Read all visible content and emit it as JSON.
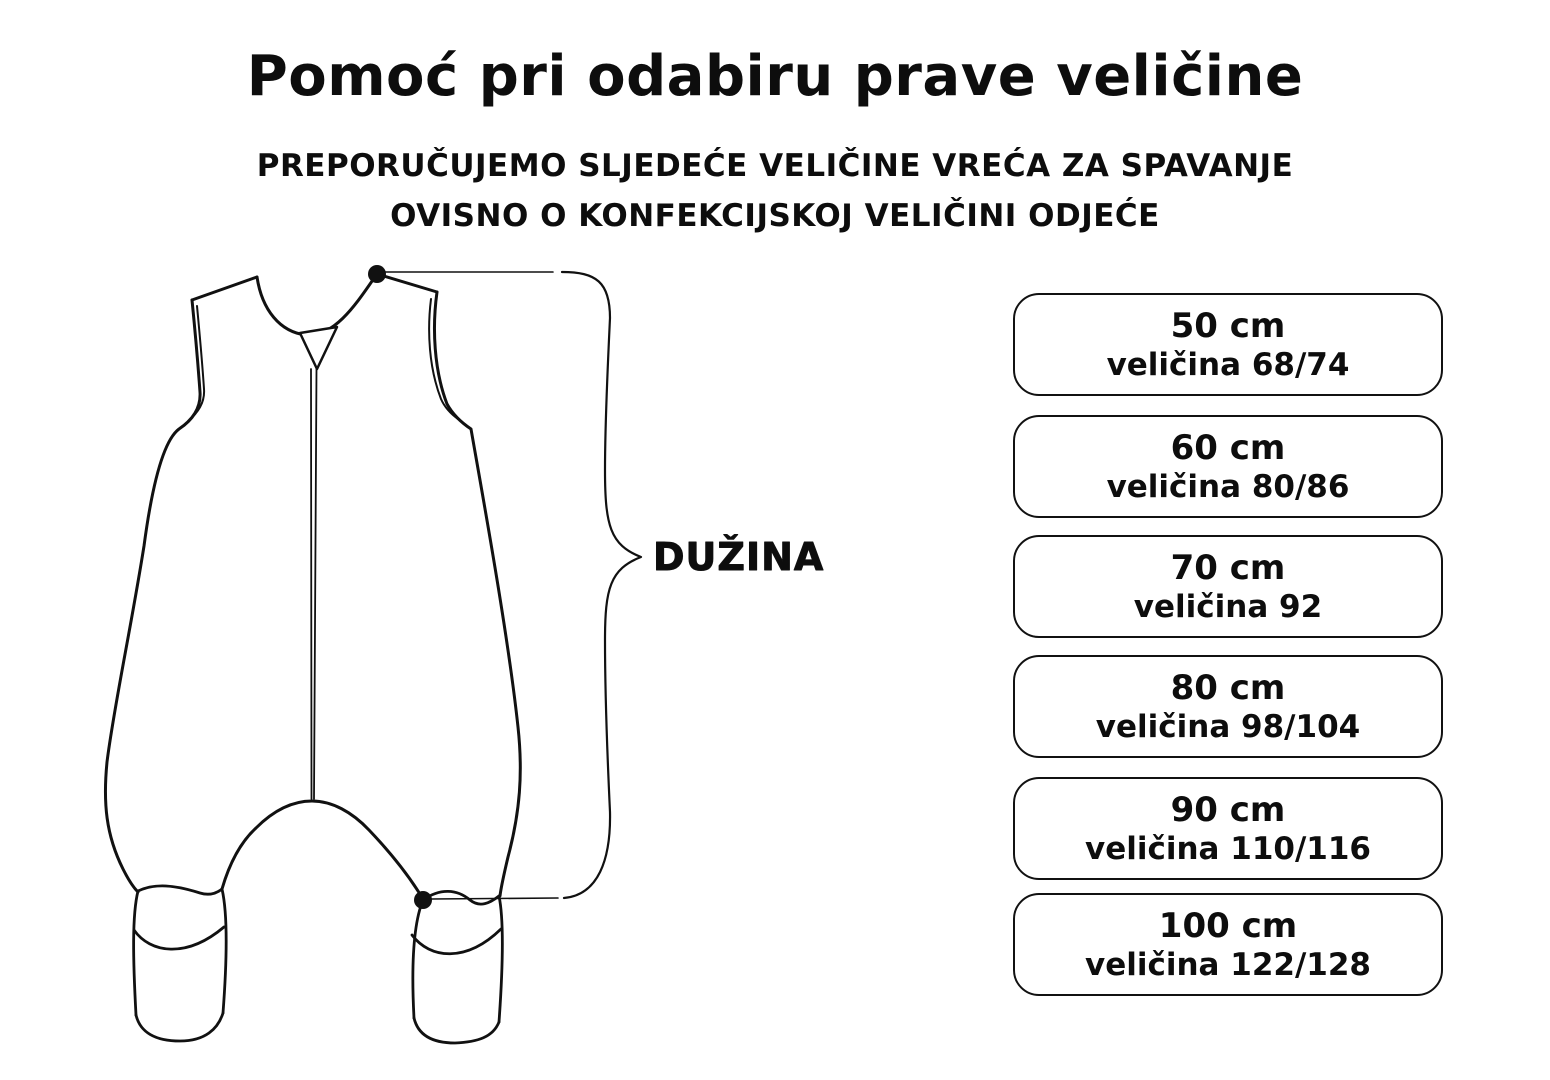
{
  "title": "Pomoć pri odabiru prave veličine",
  "subtitle": {
    "line1": "PREPORUČUJEMO SLJEDEĆE VELIČINE VREĆA ZA SPAVANJE",
    "line2": "OVISNO O KONFEKCIJSKOJ VELIČINI ODJEĆE"
  },
  "diagram": {
    "length_label": "DUŽINA"
  },
  "sizes": [
    {
      "length": "50 cm",
      "clothing_size": "veličina 68/74"
    },
    {
      "length": "60 cm",
      "clothing_size": "veličina 80/86"
    },
    {
      "length": "70 cm",
      "clothing_size": "veličina 92"
    },
    {
      "length": "80 cm",
      "clothing_size": "veličina 98/104"
    },
    {
      "length": "90 cm",
      "clothing_size": "veličina 110/116"
    },
    {
      "length": "100 cm",
      "clothing_size": "veličina 122/128"
    }
  ],
  "colors": {
    "ink": "#111111",
    "background": "#ffffff"
  }
}
